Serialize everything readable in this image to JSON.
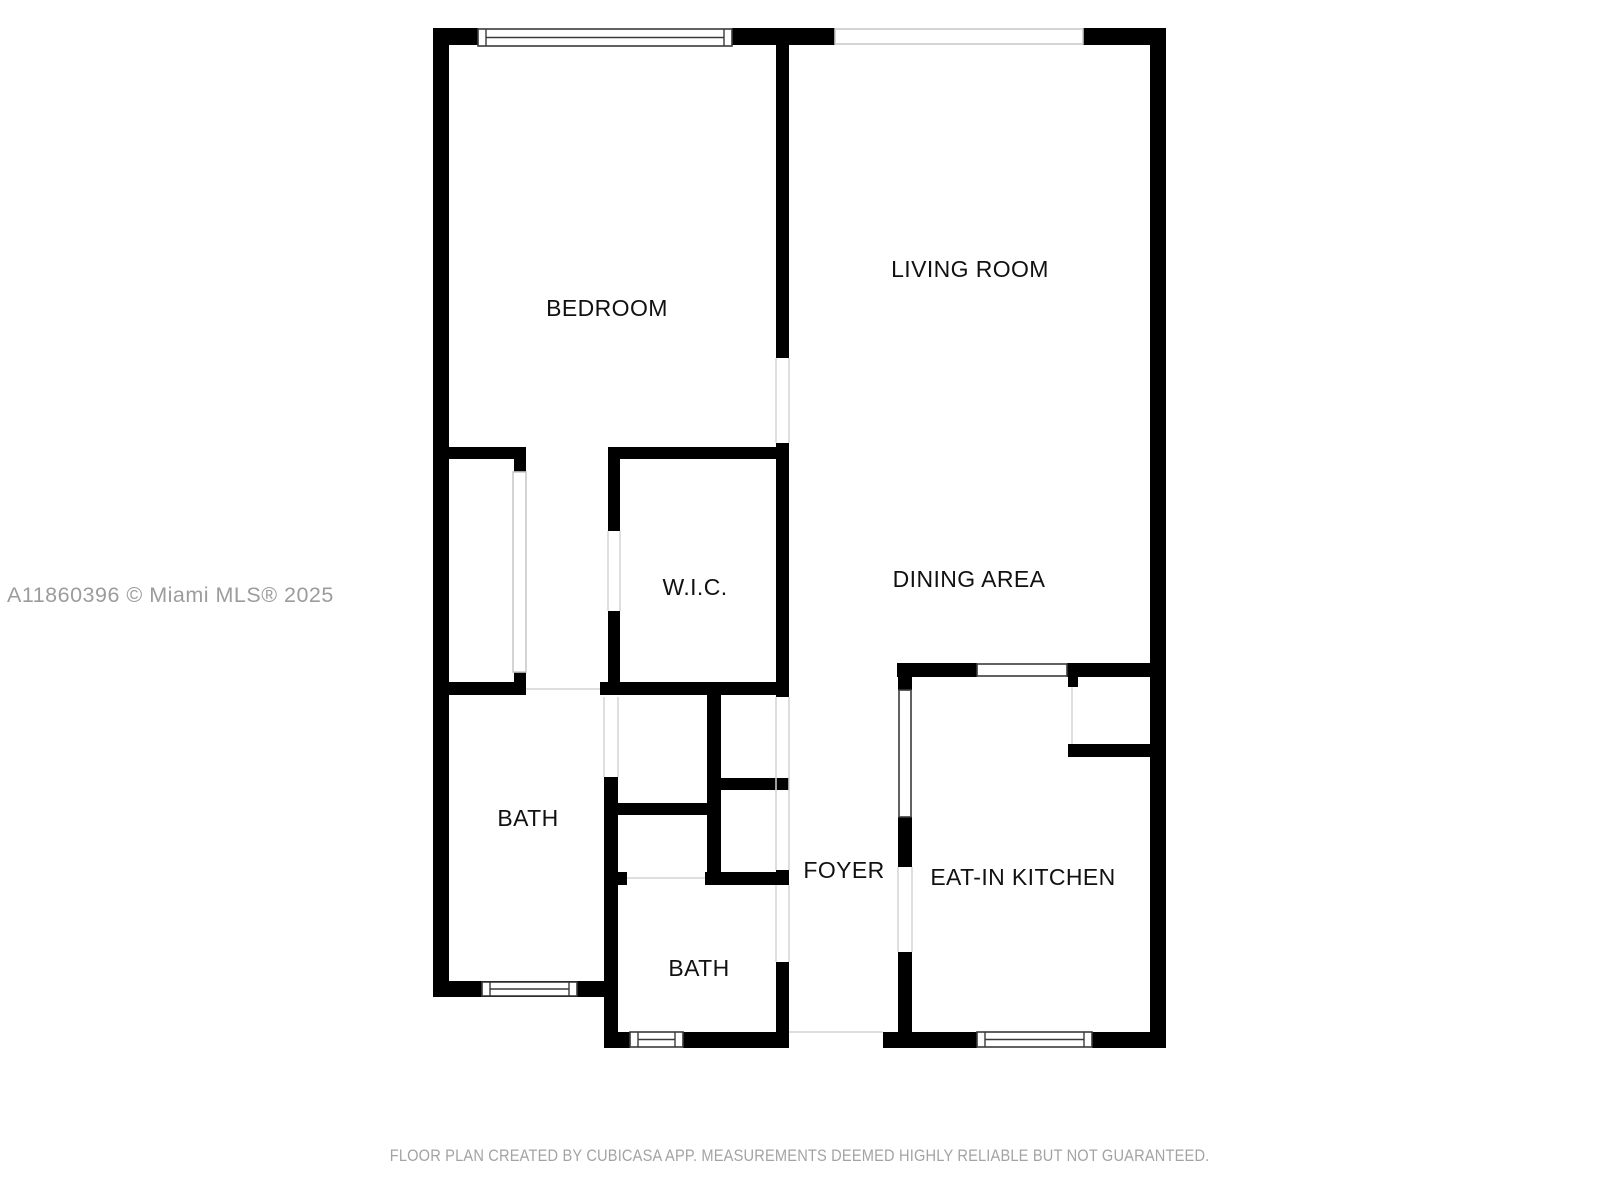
{
  "page": {
    "background": "#ffffff",
    "watermark": "A11860396 © Miami MLS® 2025",
    "footer": "FLOOR PLAN CREATED BY CUBICASA APP. MEASUREMENTS DEEMED HIGHLY RELIABLE BUT NOT GUARANTEED."
  },
  "colors": {
    "wall": "#000000",
    "window_border": "#3a3a3a",
    "light_border": "#c9c9c9",
    "boundary_line": "#d4d4d4",
    "label_text": "#111111",
    "watermark_text": "#9c9c9c",
    "footer_text": "#a3a3a3"
  },
  "floorplan": {
    "rooms": [
      {
        "id": "bedroom",
        "label": "BEDROOM",
        "x": 607,
        "y": 308
      },
      {
        "id": "living-room",
        "label": "LIVING ROOM",
        "x": 970,
        "y": 269
      },
      {
        "id": "wic",
        "label": "W.I.C.",
        "x": 695,
        "y": 587
      },
      {
        "id": "dining-area",
        "label": "DINING AREA",
        "x": 969,
        "y": 579
      },
      {
        "id": "bath-1",
        "label": "BATH",
        "x": 528,
        "y": 818
      },
      {
        "id": "foyer",
        "label": "FOYER",
        "x": 844,
        "y": 870
      },
      {
        "id": "bath-2",
        "label": "BATH",
        "x": 699,
        "y": 968
      },
      {
        "id": "eat-in-kitchen",
        "label": "EAT-IN KITCHEN",
        "x": 1023,
        "y": 877
      }
    ],
    "walls": [
      [
        433,
        28,
        16,
        969
      ],
      [
        433,
        28,
        45,
        17
      ],
      [
        732,
        28,
        103,
        17
      ],
      [
        1083,
        28,
        83,
        17
      ],
      [
        1150,
        28,
        16,
        1020
      ],
      [
        433,
        981,
        175,
        16
      ],
      [
        604,
        777,
        14,
        271
      ],
      [
        617,
        1032,
        13,
        16
      ],
      [
        683,
        1032,
        106,
        16
      ],
      [
        883,
        1032,
        94,
        16
      ],
      [
        1092,
        1032,
        74,
        16
      ],
      [
        776,
        45,
        13,
        313
      ],
      [
        776,
        443,
        13,
        254
      ],
      [
        776,
        870,
        13,
        15
      ],
      [
        776,
        962,
        13,
        71
      ],
      [
        433,
        447,
        93,
        12
      ],
      [
        514,
        459,
        12,
        13
      ],
      [
        514,
        672,
        12,
        10
      ],
      [
        433,
        682,
        93,
        13
      ],
      [
        600,
        682,
        189,
        13
      ],
      [
        608,
        447,
        181,
        12
      ],
      [
        608,
        459,
        12,
        72
      ],
      [
        608,
        611,
        12,
        84
      ],
      [
        617,
        803,
        92,
        12
      ],
      [
        707,
        695,
        14,
        190
      ],
      [
        721,
        778,
        68,
        12
      ],
      [
        604,
        872,
        23,
        13
      ],
      [
        705,
        872,
        84,
        13
      ],
      [
        897,
        663,
        80,
        14
      ],
      [
        1067,
        663,
        99,
        14
      ],
      [
        898,
        663,
        14,
        27
      ],
      [
        898,
        817,
        14,
        50
      ],
      [
        898,
        952,
        14,
        81
      ],
      [
        1068,
        744,
        82,
        13
      ],
      [
        1068,
        677,
        10,
        10
      ]
    ],
    "windows": [
      {
        "x": 478,
        "y": 29,
        "w": 254,
        "h": 17,
        "style": "window",
        "axis": "h"
      },
      {
        "x": 482,
        "y": 982,
        "w": 95,
        "h": 14,
        "style": "window",
        "axis": "h"
      },
      {
        "x": 630,
        "y": 1032,
        "w": 53,
        "h": 15,
        "style": "window",
        "axis": "h"
      },
      {
        "x": 977,
        "y": 1032,
        "w": 115,
        "h": 15,
        "style": "window",
        "axis": "h"
      },
      {
        "x": 977,
        "y": 664,
        "w": 90,
        "h": 12,
        "style": "outlined",
        "axis": "h"
      },
      {
        "x": 899,
        "y": 690,
        "w": 12,
        "h": 127,
        "style": "outlined",
        "axis": "v"
      },
      {
        "x": 835,
        "y": 29,
        "w": 248,
        "h": 15,
        "style": "light",
        "axis": "h"
      },
      {
        "x": 513,
        "y": 472,
        "w": 13,
        "h": 200,
        "style": "light",
        "axis": "v"
      }
    ],
    "boundary_lines": [
      [
        776,
        358,
        776,
        443
      ],
      [
        789,
        358,
        789,
        443
      ],
      [
        526,
        689,
        600,
        689
      ],
      [
        608,
        531,
        608,
        611
      ],
      [
        620,
        531,
        620,
        611
      ],
      [
        604,
        697,
        604,
        777
      ],
      [
        618,
        697,
        618,
        777
      ],
      [
        776,
        697,
        776,
        870
      ],
      [
        789,
        697,
        789,
        870
      ],
      [
        776,
        885,
        776,
        962
      ],
      [
        789,
        885,
        789,
        962
      ],
      [
        627,
        878,
        705,
        878
      ],
      [
        898,
        867,
        898,
        952
      ],
      [
        912,
        867,
        912,
        952
      ],
      [
        789,
        1032,
        883,
        1032
      ],
      [
        1072,
        687,
        1072,
        744
      ]
    ]
  }
}
